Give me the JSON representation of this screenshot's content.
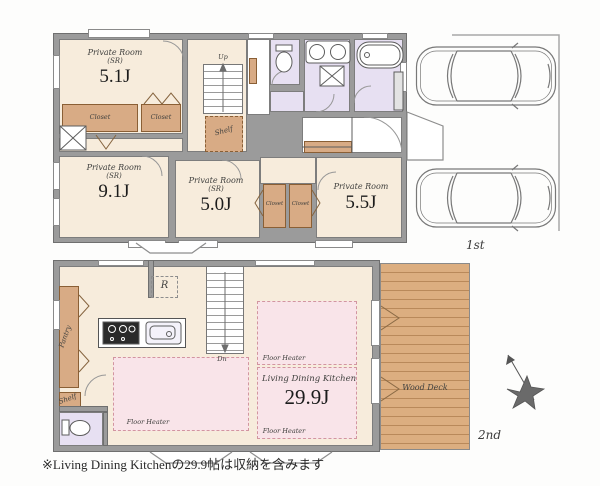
{
  "note": "※Living Dining Kitchenの29.9帖は収納を含みます",
  "floor1": {
    "tag": "1st",
    "rooms": {
      "r51": {
        "name": "Private Room",
        "sub": "(SR)",
        "size": "5.1J"
      },
      "r91": {
        "name": "Private Room",
        "sub": "(SR)",
        "size": "9.1J"
      },
      "r50": {
        "name": "Private Room",
        "sub": "(SR)",
        "size": "5.0J"
      },
      "r55": {
        "name": "Private Room",
        "size": "5.5J"
      }
    },
    "labels": {
      "closet": "Closet",
      "shelf": "Shelf",
      "up": "Up"
    }
  },
  "floor2": {
    "tag": "2nd",
    "ldk": {
      "name": "Living Dining Kitchen",
      "size": "29.9J"
    },
    "labels": {
      "floor_heater": "Floor Heater",
      "wood_deck": "Wood Deck",
      "pantry": "Pantry",
      "shelf": "Shelf",
      "fridge": "R",
      "down": "Dn"
    }
  },
  "colors": {
    "wall": "#9b9b9b",
    "room": "#f7ecdc",
    "closet": "#d8ab85",
    "wet": "#e7e0f2",
    "floor_heater": "#f9e4e9",
    "deck": "#dcae80"
  }
}
